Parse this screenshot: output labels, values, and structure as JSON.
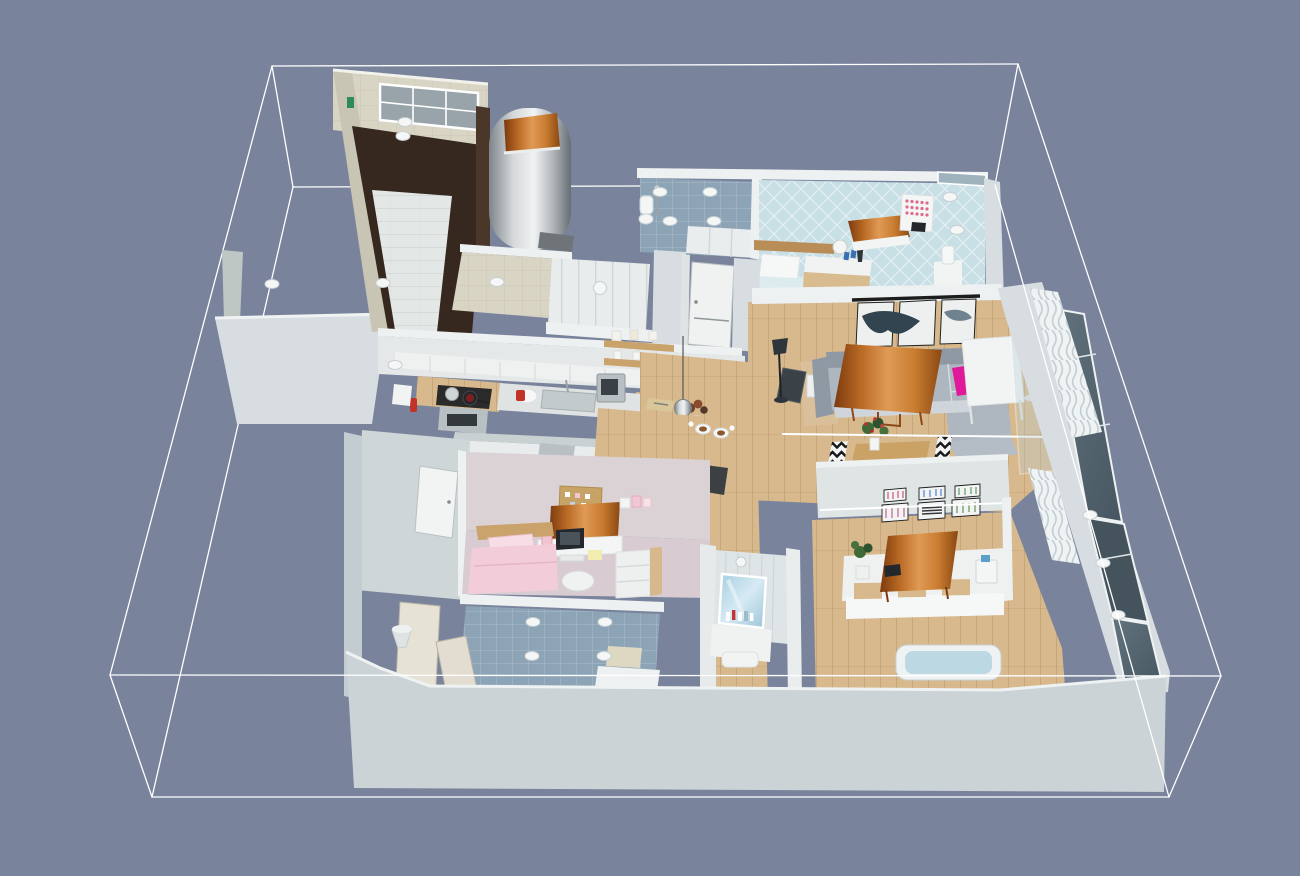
{
  "app": {
    "view": "3d-floor-plan-perspective",
    "description": "Bird's-eye 3D render of an apartment interior inside a white wireframe bounding box on a slate background"
  },
  "palette": {
    "bg": "#79839b",
    "wire": "#ffffff",
    "wallTop": "#eef1f2",
    "wallLight": "#d7dde0",
    "wallMid": "#c3ccd0",
    "wallShadow": "#aab4b9",
    "beige": "#d9d5c5",
    "beigeDark": "#c9c5b4",
    "darkFloor": "#36271f",
    "brownWall": "#4a372a",
    "tileLight": "#e3e7e5",
    "blueTile": "#8ca4b6",
    "bedroomBlue": "#c8dfe5",
    "wood": "#d8b98d",
    "woodDark": "#c9a36b",
    "copperDark": "#7c3a0e",
    "copperLight": "#e09a55",
    "sofaBack": "#8f99a4",
    "sofaSeat": "#aeb6bf",
    "sofaLight": "#cfd5da",
    "magenta": "#e0189a",
    "pinkBed": "#f3ccd9",
    "pinkPillow": "#f7dde6",
    "lavender": "#d8ccd2",
    "wallPink": "#dbd2d6",
    "artTeal": "#31444f",
    "glass": "#5f707a",
    "glassDark": "#45545c",
    "curtain": "#f0f3f4",
    "green": "#3f6a38",
    "dark": "#24282c"
  },
  "scene": {
    "ceiling_lamps": [
      [
        405,
        122
      ],
      [
        403,
        136
      ],
      [
        383,
        283
      ],
      [
        497,
        282
      ],
      [
        660,
        192
      ],
      [
        710,
        192
      ],
      [
        670,
        221
      ],
      [
        714,
        221
      ],
      [
        950,
        197
      ],
      [
        957,
        230
      ],
      [
        395,
        365
      ],
      [
        533,
        622
      ],
      [
        605,
        622
      ],
      [
        532,
        656
      ],
      [
        604,
        656
      ],
      [
        1090,
        515
      ],
      [
        1103,
        563
      ],
      [
        1118,
        615
      ],
      [
        272,
        284
      ]
    ],
    "rooms": [
      {
        "name": "entry-hall",
        "floor": "dark-wood-with-light-tile-steps",
        "features": [
          "barred-window",
          "exit-sign",
          "round-metal-cabin-with-copper-top",
          "beige-tiled-walls"
        ]
      },
      {
        "name": "bathroom-top",
        "floor": "blue-tile",
        "features": [
          "toilet",
          "shower",
          "white-cabinets",
          "ceiling-lamps"
        ]
      },
      {
        "name": "master-bedroom",
        "floor": "light-blue-lattice",
        "features": [
          "single-bed-white-pillow",
          "copper-duvet-bed",
          "nightstand-with-lamp-and-vase",
          "polka-dot-wall-art",
          "humidifier"
        ]
      },
      {
        "name": "wardrobe-corridor",
        "floor": "beige-tile",
        "features": [
          "white-closet-panels",
          "round-ceiling-lamp",
          "white-door"
        ]
      },
      {
        "name": "kitchen",
        "floor": "wood",
        "features": [
          "cooktop-with-pots",
          "oven",
          "sink",
          "microwave",
          "wood-wall-shelves-with-jars",
          "pendant-sphere-lamp",
          "island-counter",
          "dining-table-with-two-place-settings",
          "fridge"
        ]
      },
      {
        "name": "living-room",
        "floor": "wood",
        "features": [
          "corner-sofa-gray",
          "copper-dining-table",
          "white-table",
          "magenta-cushion",
          "triptych-wall-art",
          "chevron-rug",
          "wood-coffee-table",
          "red-flower-bouquet",
          "black-floor-lamp",
          "drum-floor-lamp",
          "tv-panel",
          "sideboard"
        ]
      },
      {
        "name": "kids-bedroom",
        "floor": "lavender",
        "features": [
          "pink-bed",
          "desk-with-monitor-and-keyboard",
          "desk-chair",
          "corkboard",
          "copper-wardrobe-top",
          "white-drawer-unit"
        ]
      },
      {
        "name": "bathroom-left",
        "floor": "blue-tile",
        "features": [
          "bath-mat",
          "white-vanity",
          "two-doors",
          "cone-lamp"
        ]
      },
      {
        "name": "bathroom-center",
        "floor": "white",
        "features": [
          "wall-mirror",
          "vanity-with-toiletries",
          "wall-lamp"
        ]
      },
      {
        "name": "office-bedroom",
        "floor": "wood",
        "features": [
          "white-counter-with-wood-drawers",
          "tilted-copper-desk",
          "potted-plant",
          "printer",
          "six-display-frames",
          "blue-tub"
        ]
      },
      {
        "name": "window-wall-east",
        "floor": "",
        "features": [
          "dark-glass-panels",
          "white-wavy-curtains",
          "glass-partition"
        ]
      }
    ]
  }
}
